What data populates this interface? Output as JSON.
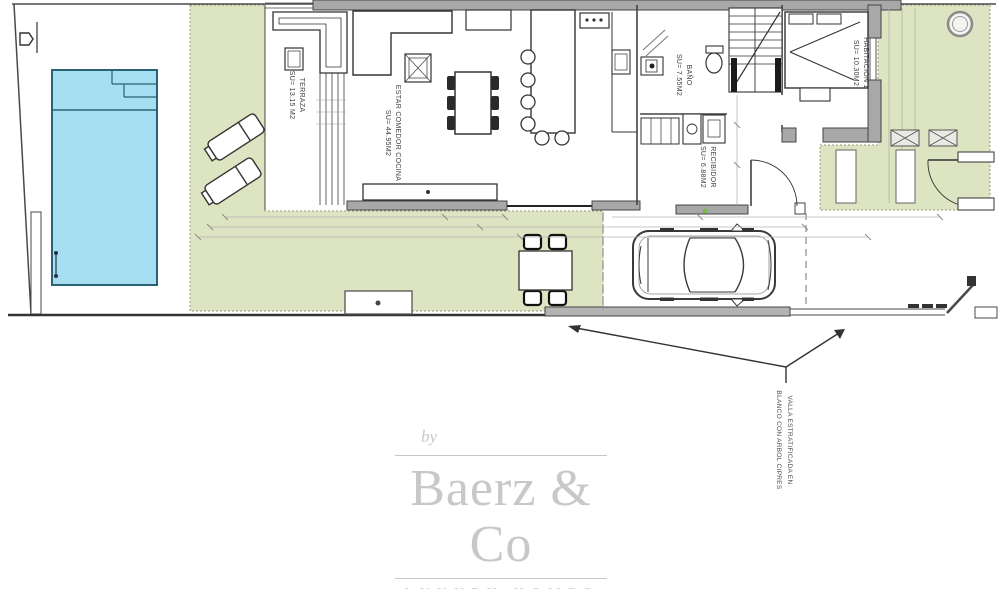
{
  "rooms": [
    {
      "name": "TERRAZA",
      "area": "SU= 13.15 M2"
    },
    {
      "name": "ESTAR COMEDOR COCINA",
      "area": "SU= 44.95M2"
    },
    {
      "name": "BAÑO",
      "area": "SU= 7.55M2"
    },
    {
      "name": "RECIBIDOR",
      "area": "SU= 6.88M2"
    },
    {
      "name": "HABITACIÓN 1",
      "area": "SU= 10.30M2"
    }
  ],
  "annotation": {
    "line1": "VALLA ESTRATIFICADA EN",
    "line2": "BLANCO CON ARBOL CIPRES"
  },
  "branding": {
    "prefix": "by",
    "name": "Baerz & Co",
    "tagline": "LUXURY HOMES"
  },
  "colors": {
    "terrace_green": "#dde4c1",
    "pool_blue": "#a8def2",
    "pool_border": "#2a6375",
    "wall_gray": "#a8a8a8",
    "line_dark": "#3f3f3f",
    "logo_gray": "#c8c8c8"
  }
}
